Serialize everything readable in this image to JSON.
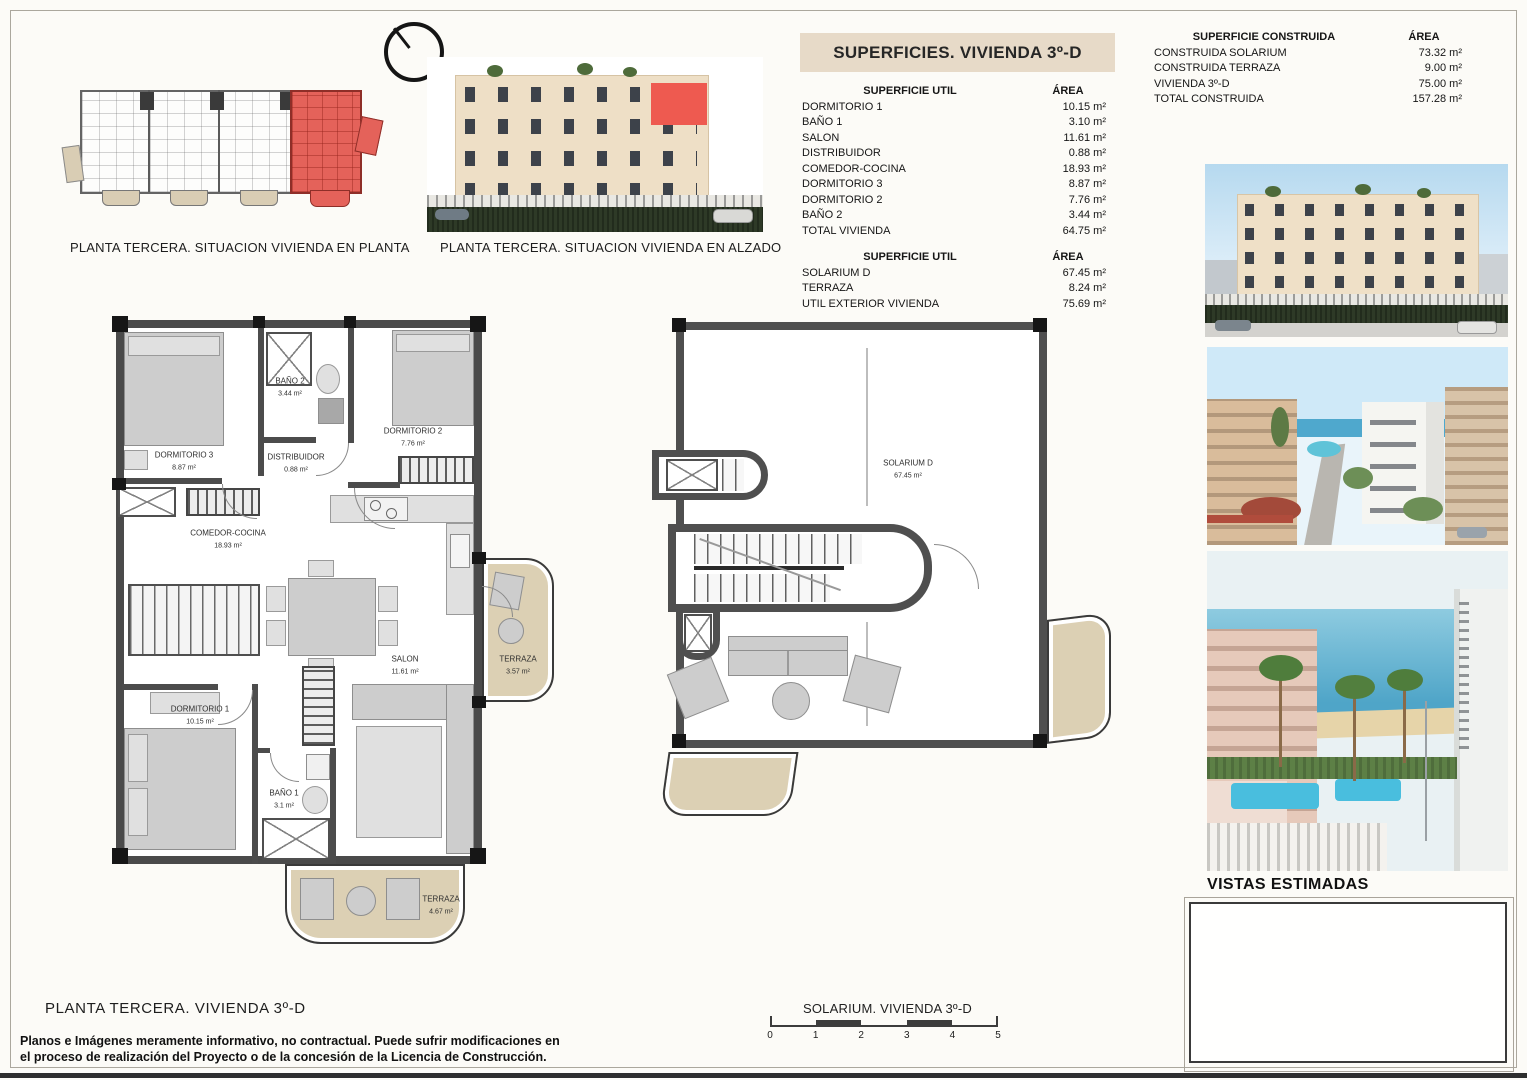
{
  "colors": {
    "accent_red": "#e4574f",
    "band_tan": "#e7dac8",
    "terrace_beige": "#dcd0b4"
  },
  "key_plan": {
    "caption": "PLANTA TERCERA. SITUACION VIVIENDA EN PLANTA"
  },
  "elevation": {
    "caption": "PLANTA TERCERA. SITUACION VIVIENDA EN ALZADO"
  },
  "superficies": {
    "title": "SUPERFICIES. VIVIENDA 3º-D",
    "util": {
      "col_label": "SUPERFICIE UTIL",
      "col_area": "ÁREA",
      "rows": [
        {
          "label": "DORMITORIO 1",
          "area": "10.15 m²"
        },
        {
          "label": "BAÑO 1",
          "area": "3.10 m²"
        },
        {
          "label": "SALON",
          "area": "11.61 m²"
        },
        {
          "label": "DISTRIBUIDOR",
          "area": "0.88 m²"
        },
        {
          "label": "COMEDOR-COCINA",
          "area": "18.93 m²"
        },
        {
          "label": "DORMITORIO 3",
          "area": "8.87 m²"
        },
        {
          "label": "DORMITORIO 2",
          "area": "7.76 m²"
        },
        {
          "label": "BAÑO 2",
          "area": "3.44 m²"
        },
        {
          "label": "TOTAL VIVIENDA",
          "area": "64.75 m²"
        }
      ]
    },
    "exterior": {
      "col_label": "SUPERFICIE UTIL",
      "col_area": "ÁREA",
      "rows": [
        {
          "label": "SOLARIUM D",
          "area": "67.45 m²"
        },
        {
          "label": "TERRAZA",
          "area": "8.24 m²"
        },
        {
          "label": "UTIL EXTERIOR VIVIENDA",
          "area": "75.69 m²"
        }
      ]
    }
  },
  "construida": {
    "col_label": "SUPERFICIE CONSTRUIDA",
    "col_area": "ÁREA",
    "rows": [
      {
        "label": "CONSTRUIDA SOLARIUM",
        "area": "73.32 m²"
      },
      {
        "label": "CONSTRUIDA TERRAZA",
        "area": "9.00 m²"
      },
      {
        "label": "VIVIENDA 3º-D",
        "area": "75.00 m²"
      },
      {
        "label": "TOTAL CONSTRUIDA",
        "area": "157.28 m²"
      }
    ]
  },
  "floor_plan": {
    "caption": "PLANTA  TERCERA. VIVIENDA 3º-D",
    "rooms": [
      {
        "name": "DORMITORIO 3",
        "area": "8.87 m²"
      },
      {
        "name": "BAÑO 2",
        "area": "3.44 m²"
      },
      {
        "name": "DORMITORIO 2",
        "area": "7.76 m²"
      },
      {
        "name": "DISTRIBUIDOR",
        "area": "0.88 m²"
      },
      {
        "name": "COMEDOR-COCINA",
        "area": "18.93 m²"
      },
      {
        "name": "SALON",
        "area": "11.61 m²"
      },
      {
        "name": "DORMITORIO 1",
        "area": "10.15 m²"
      },
      {
        "name": "BAÑO 1",
        "area": "3.1 m²"
      },
      {
        "name": "TERRAZA",
        "area": "3.57 m²"
      },
      {
        "name": "TERRAZA",
        "area": "4.67 m²"
      }
    ]
  },
  "solarium_plan": {
    "caption": "SOLARIUM. VIVIENDA 3º-D",
    "room": {
      "name": "SOLARIUM D",
      "area": "67.45 m²"
    },
    "scale_ticks": [
      "0",
      "1",
      "2",
      "3",
      "4",
      "5"
    ]
  },
  "views": {
    "title": "VISTAS ESTIMADAS"
  },
  "disclaimer": {
    "line1": "Planos e Imágenes meramente informativo, no contractual. Puede sufrir modificaciones en",
    "line2": "el proceso de realización del Proyecto o de la concesión de la Licencia de Construcción."
  }
}
